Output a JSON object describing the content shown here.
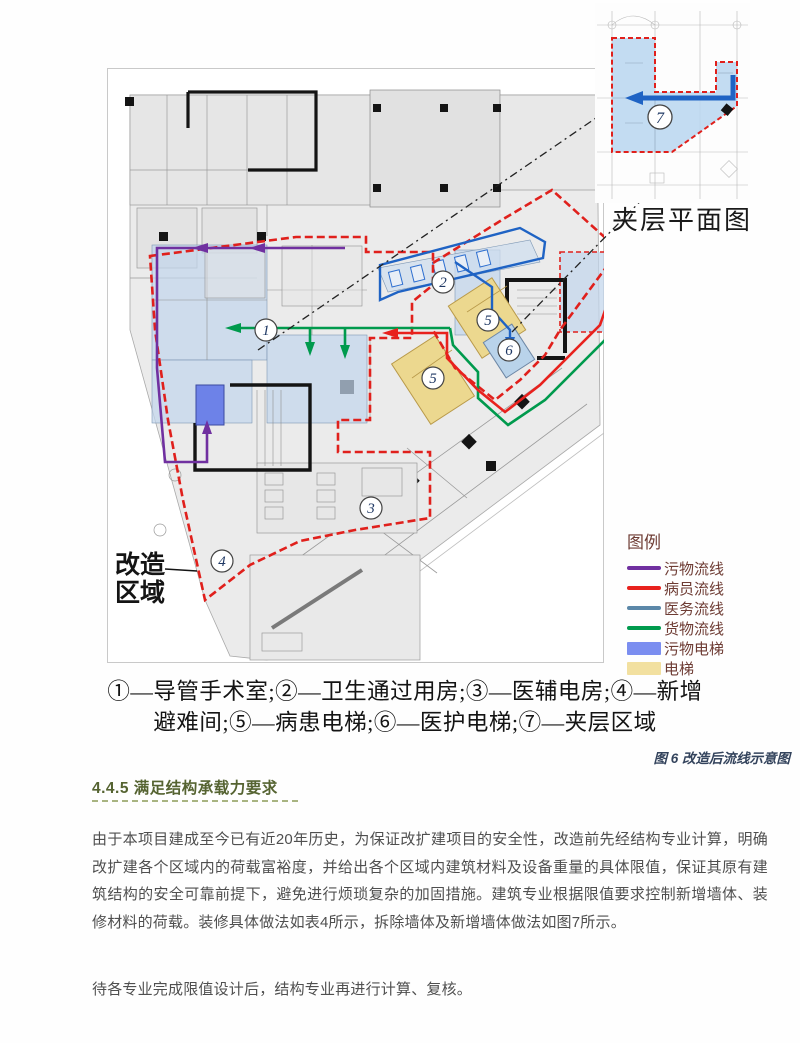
{
  "figure": {
    "inset_caption": "夹层平面图",
    "region_label": {
      "line1": "改造",
      "line2": "区域"
    },
    "markers": {
      "m1": "1",
      "m2": "2",
      "m3": "3",
      "m4": "4",
      "m5": "5",
      "m6": "6",
      "m7": "7"
    },
    "legend": {
      "title": "图例",
      "items": [
        {
          "label": "污物流线",
          "swatch": "line",
          "color": "#7030a0"
        },
        {
          "label": "病员流线",
          "swatch": "line",
          "color": "#e8211d"
        },
        {
          "label": "医务流线",
          "swatch": "line",
          "color": "#5b87a8"
        },
        {
          "label": "货物流线",
          "swatch": "line",
          "color": "#009a4d"
        },
        {
          "label": "污物电梯",
          "swatch": "box",
          "color": "#7b8ef0"
        },
        {
          "label": "电梯",
          "swatch": "box",
          "color": "#f2e0a0"
        }
      ]
    },
    "caption_line1": "①—导管手术室;②—卫生通过用房;③—医辅电房;④—新增",
    "caption_line2": "避难间;⑤—病患电梯;⑥—医护电梯;⑦—夹层区域",
    "figure_caption": "图 6 改造后流线示意图"
  },
  "section": {
    "heading": "4.4.5 满足结构承载力要求",
    "paragraph1": "由于本项目建成至今已有近20年历史，为保证改扩建项目的安全性，改造前先经结构专业计算，明确改扩建各个区域内的荷载富裕度，并给出各个区域内建筑材料及设备重量的具体限值，保证其原有建筑结构的安全可靠前提下，避免进行烦琐复杂的加固措施。建筑专业根据限值要求控制新增墙体、装修材料的荷载。装修具体做法如表4所示，拆除墙体及新增墙体做法如图7所示。",
    "paragraph2": "待各专业完成限值设计后，结构专业再进行计算、复核。"
  },
  "colors": {
    "renovation_boundary": "#e0201c",
    "waste_flow": "#7030a0",
    "patient_flow": "#e8211d",
    "medical_flow": "#1f63c4",
    "goods_flow": "#009a4d",
    "waste_elevator_fill": "#6d82e8",
    "elevator_fill": "#ecd88f",
    "blue_room_fill": "#c2d6ec",
    "heading_green": "#556331",
    "figure_caption_blue": "#33435c"
  }
}
